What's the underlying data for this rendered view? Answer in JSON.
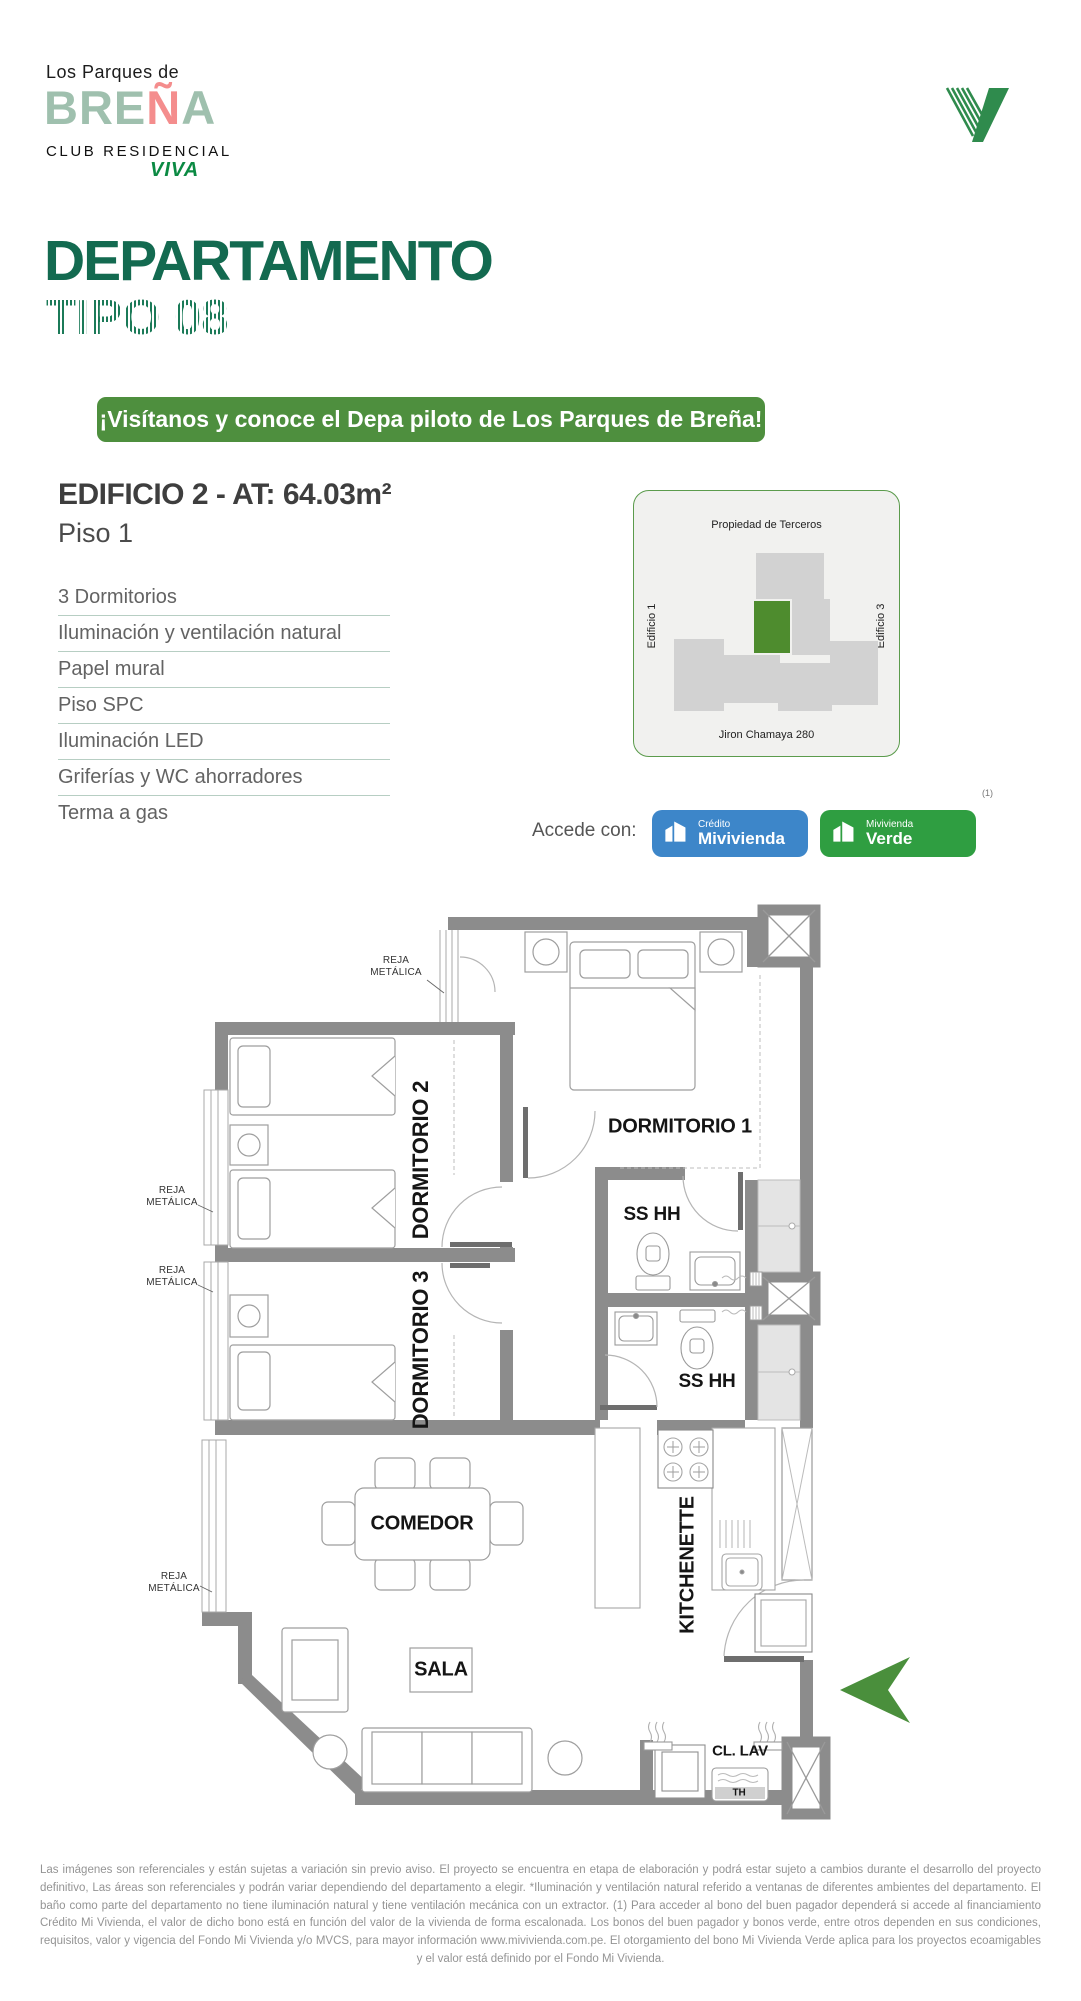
{
  "brand": {
    "tagline": "Los Parques de",
    "name_pre": "BRE",
    "name_n": "Ñ",
    "name_post": "A",
    "subtitle": "CLUB RESIDENCIAL",
    "viva": "VIVA"
  },
  "title": {
    "main": "DEPARTAMENTO",
    "sub": "TIPO 08"
  },
  "banner": {
    "text": "¡Visítanos y conoce el Depa piloto de Los Parques de Breña!"
  },
  "unit": {
    "heading": "EDIFICIO 2 - AT: 64.03m²",
    "floor": "Piso 1",
    "features": [
      "3 Dormitorios",
      "Iluminación y ventilación natural",
      "Papel mural",
      "Piso SPC",
      "Iluminación LED",
      "Griferías y WC ahorradores",
      "Terma a gas"
    ]
  },
  "site_map": {
    "top": "Propiedad de Terceros",
    "left": "Edificio 1",
    "right": "Edificio 3",
    "bottom": "Jiron Chamaya 280"
  },
  "access": {
    "label": "Accede con:",
    "note": "(1)",
    "badges": [
      {
        "line1": "Crédito",
        "line2": "Mivivienda",
        "color": "#3D86C9"
      },
      {
        "line1": "Mivivienda",
        "line2": "Verde",
        "color": "#2F9E41"
      }
    ]
  },
  "plan": {
    "dorm1": "DORMITORIO 1",
    "dorm2": "DORMITORIO 2",
    "dorm3": "DORMITORIO 3",
    "bath1": "SS HH",
    "bath2": "SS HH",
    "comedor": "COMEDOR",
    "sala": "SALA",
    "kitchenette": "KITCHENETTE",
    "cl_lav": "CL. LAV",
    "th": "TH",
    "reja": "REJA METÁLICA"
  },
  "colors": {
    "title_green": "#136A50",
    "banner_green": "#4E8F3E",
    "badge_blue": "#3D86C9",
    "badge_green": "#2F9E41",
    "map_highlight_green": "#4E8C2E",
    "logo_sage": "#9FC0AE",
    "logo_pink": "#F48D8D",
    "wall_gray": "#8C8C8C",
    "arrow_green": "#4A8F3C"
  },
  "footer": {
    "text": "Las imágenes son referenciales y están sujetas a variación sin previo aviso. El proyecto se encuentra en etapa de elaboración y podrá estar sujeto a cambios durante el desarrollo del proyecto definitivo, Las áreas son referenciales y podrán variar dependiendo del departamento a elegir. *Iluminación y ventilación natural referido a ventanas de diferentes ambientes del departamento. El baño como parte del departamento no tiene iluminación natural y tiene ventilación mecánica con un extractor. (1) Para acceder al bono del buen pagador dependerá si accede al financiamiento Crédito Mi Vivienda, el valor de dicho bono está en función del valor de la vivienda de forma escalonada. Los bonos del buen pagador y bonos verde, entre otros dependen en sus condiciones, requisitos, valor y vigencia del Fondo Mi Vivienda y/o MVCS, para mayor información www.mivivienda.com.pe. El otorgamiento del bono Mi Vivienda Verde aplica para los proyectos ecoamigables y el valor está definido por el Fondo Mi Vivienda."
  }
}
